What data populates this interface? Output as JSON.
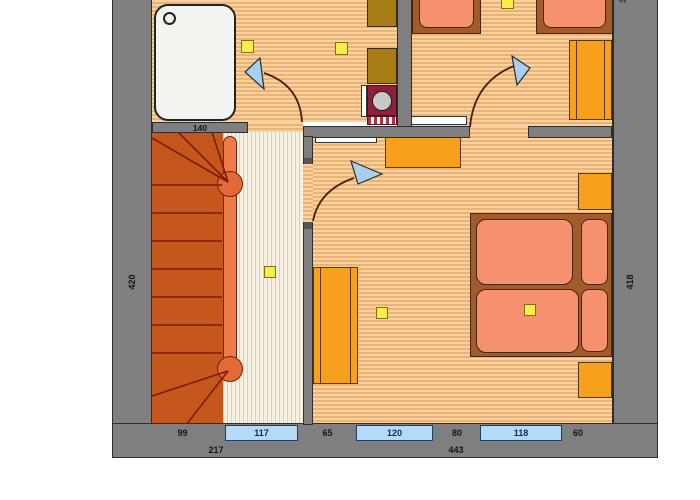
{
  "plan_labels": {
    "wall_width": "140",
    "left_height": "420",
    "right_height": "418",
    "top_right_partial": "3"
  },
  "dimensions": {
    "row1": [
      "99",
      "117",
      "65",
      "120",
      "80",
      "118",
      "60"
    ],
    "row2": [
      "217",
      "443"
    ]
  },
  "colors": {
    "wall_gray": "#7f7f7f",
    "floor_orange_stripe": "#edb273",
    "corridor_cream_stripe": "#d6d0b4",
    "stairs_orange_red": "#c5571d",
    "handrail_orange": "#ec7b4d",
    "furniture_orange": "#f6a01c",
    "bed_frame_brown": "#a15c2b",
    "mattress_salmon": "#f5916e",
    "cabinet_brown": "#a87c15",
    "washbasin_maroon": "#8e1f38",
    "door_arrow_blue": "#a8d0ee",
    "ceiling_light_yellow": "#f7ec49",
    "dimension_box_blue": "#b5daf5"
  }
}
